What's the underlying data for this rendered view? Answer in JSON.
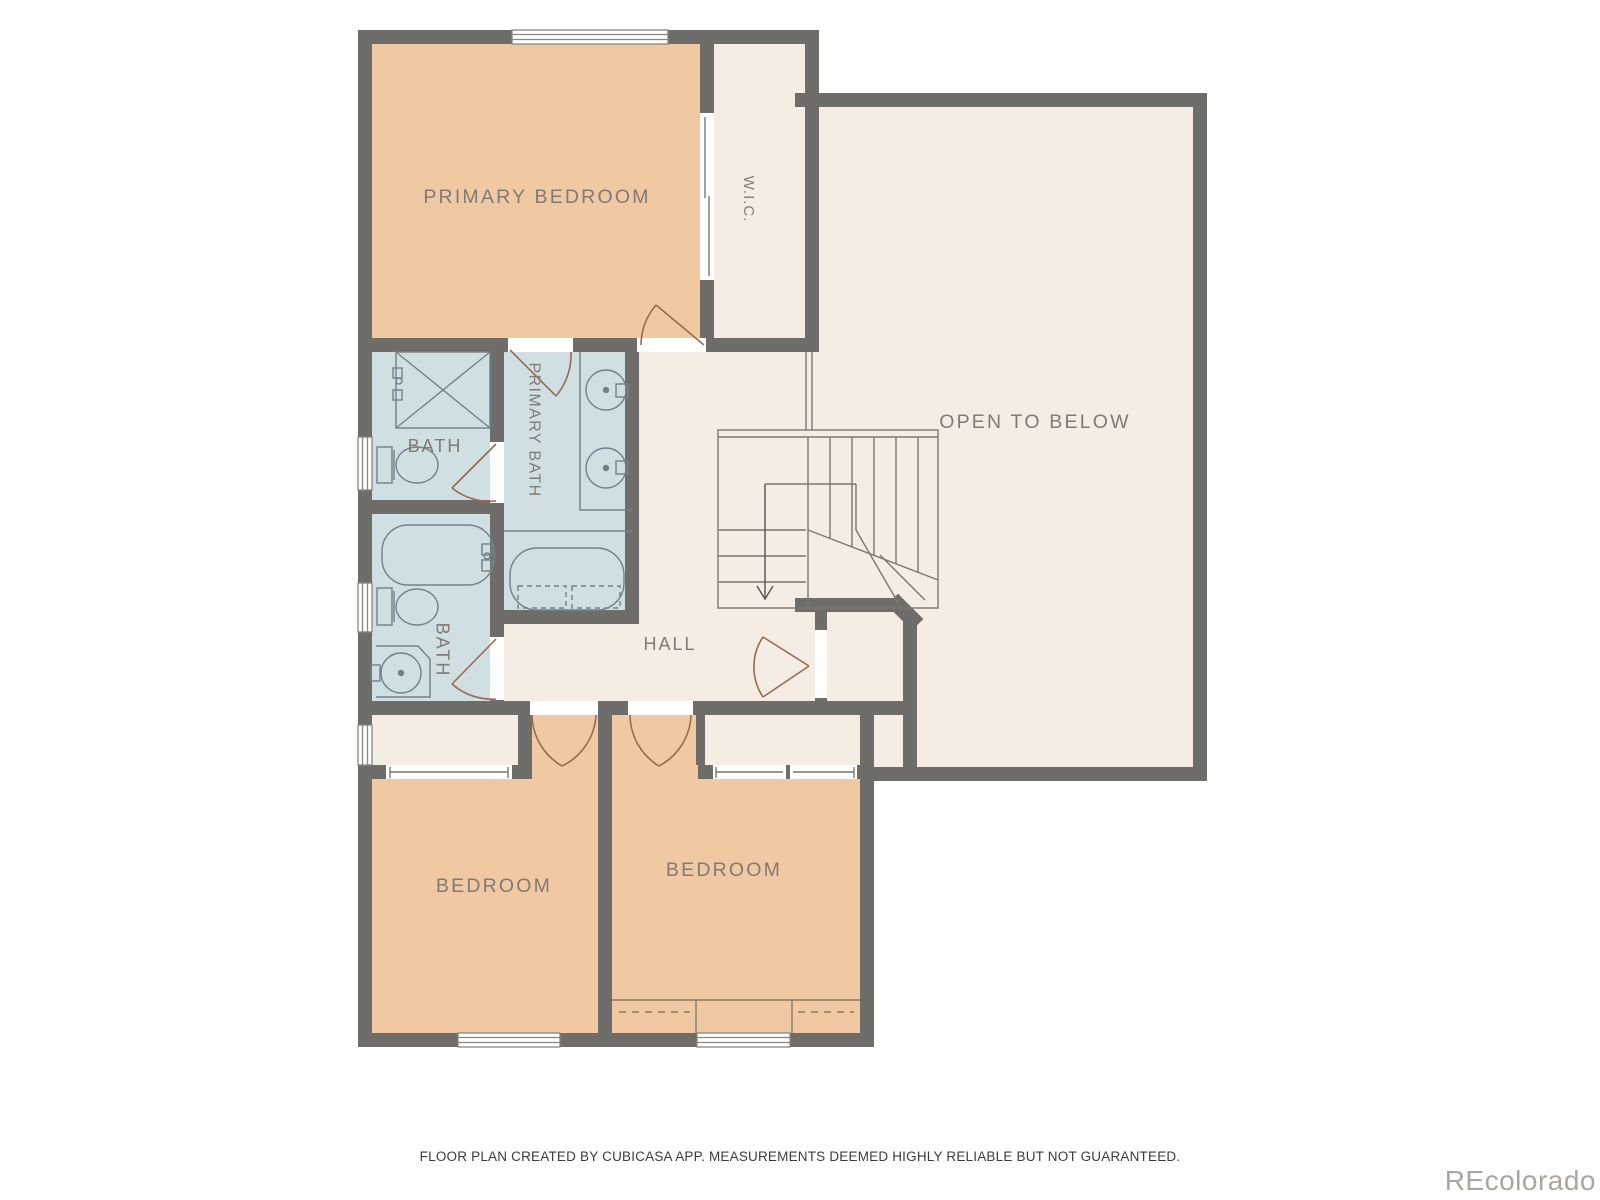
{
  "plan": {
    "rooms": {
      "primary_bedroom": {
        "label": "PRIMARY BEDROOM"
      },
      "wic": {
        "label": "W.I.C."
      },
      "open_to_below": {
        "label": "OPEN TO BELOW"
      },
      "bath_upper": {
        "label": "BATH"
      },
      "primary_bath": {
        "label": "PRIMARY BATH"
      },
      "bath_lower": {
        "label": "BATH"
      },
      "hall": {
        "label": "HALL"
      },
      "bedroom_left": {
        "label": "BEDROOM"
      },
      "bedroom_right": {
        "label": "BEDROOM"
      }
    },
    "fixtures": [
      "shower-icon",
      "toilet-icon",
      "bathtub-icon",
      "sink-icon",
      "double-vanity-icon",
      "staircase-icon",
      "down-arrow-icon",
      "door-swing-icon",
      "window-icon",
      "closet-rod-dashed-line"
    ],
    "colors": {
      "wall": "#6f6d69",
      "bedroom_fill": "#f0c9a2",
      "bath_fill": "#d0e0e2",
      "floor_fill": "#f5ece3",
      "door_arc": "#9a6a4e",
      "fixture_line": "#73808a",
      "thin_line": "#7b776f",
      "label_text": "#807b74",
      "disclaimer_text": "#3c3c3c",
      "watermark_text": "#aaa6a1"
    }
  },
  "footer": {
    "disclaimer": "FLOOR PLAN CREATED BY CUBICASA APP. MEASUREMENTS DEEMED HIGHLY RELIABLE BUT NOT GUARANTEED."
  },
  "watermark": {
    "text": "REcolorado"
  }
}
